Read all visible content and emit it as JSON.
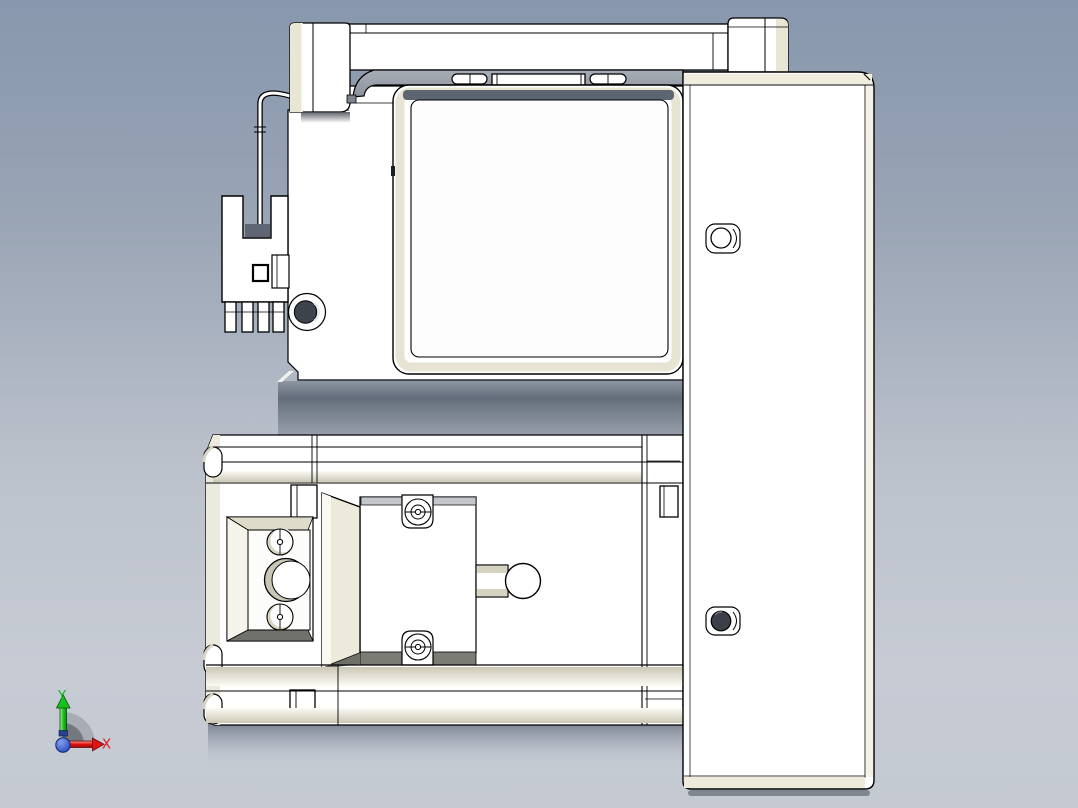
{
  "canvas": {
    "kind": "cad-viewport-preview",
    "background": {
      "top": "#8897ad",
      "upper_mid": "#9aa5b5",
      "lower_mid": "#bcc2cc",
      "bottom": "#c4c9d2"
    }
  },
  "model": {
    "edge_color": "#000000",
    "face_color": "#ffffff",
    "shade_cream": "#e9e6d6",
    "flange_gray": "#9ba1aa",
    "underside_dark": "#626c79",
    "bolt_fill": "#3a3f48"
  },
  "triad": {
    "y_label": "Y",
    "x_label": "X",
    "y_color": "#10b919",
    "x_color": "#e3171c",
    "origin_color": "#1c3fb6",
    "arc_outer": "#a8adb5",
    "arc_inner": "#74787f"
  }
}
